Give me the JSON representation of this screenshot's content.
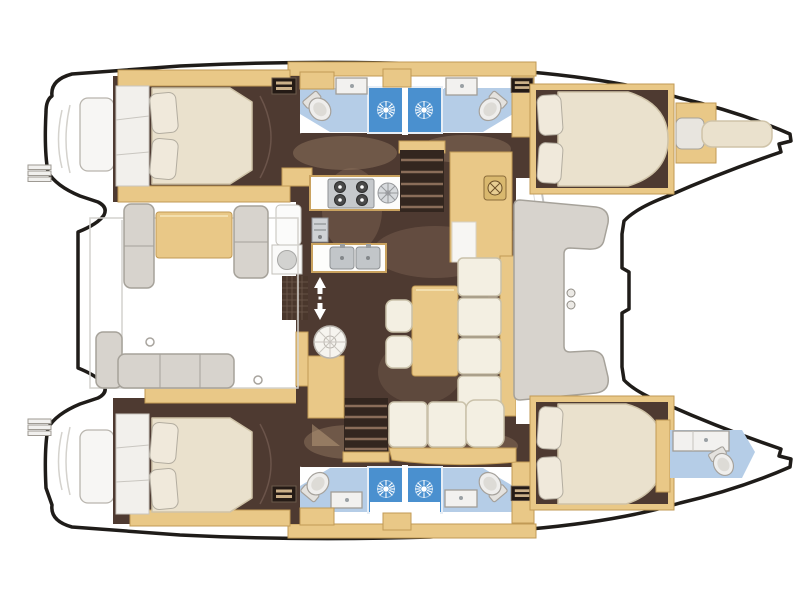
{
  "diagram": {
    "type": "boat-floor-plan",
    "subject": "catamaran-accommodation-layout-top-view",
    "orientation": "bows-right-sterns-left",
    "regions": [
      "port-stern-platform-with-steps",
      "starboard-stern-platform-with-steps",
      "aft-cockpit-with-table-and-benches",
      "port-aft-cabin-double-bed",
      "starboard-aft-cabin-double-bed",
      "port-aft-head-with-shower",
      "port-forward-head-with-shower",
      "starboard-aft-head-with-shower",
      "starboard-forward-head-with-shower",
      "saloon-galley-with-stove-and-sinks",
      "saloon-dinette-with-table-and-sofa",
      "nav-station-desk",
      "companionway-stairs-port",
      "companionway-stairs-starboard",
      "forward-cockpit-c-bench",
      "port-forward-cabin-double-bed",
      "starboard-forward-cabin-double-bed",
      "port-bow-crew-berth",
      "starboard-bow-head"
    ]
  },
  "colors": {
    "outline": "#1f1c19",
    "deck": "#ffffff",
    "deck_line": "#d4d2cd",
    "floor_dark": "#4e3a31",
    "floor_shadow": "#9a7f67",
    "wood": "#e9c887",
    "wood_edge": "#c19a55",
    "mattress": "#eae1cd",
    "mattress_edge": "#cfc3a8",
    "pillow": "#f0e9db",
    "bath_floor": "#b5cde7",
    "shower_blue": "#4a90cf",
    "shower_edge": "#e7eef6",
    "fixture_white": "#f2f1ef",
    "fixture_gray": "#d8d7d3",
    "fixture_edge": "#a29e97",
    "sofa": "#f3efe2",
    "sofa_edge": "#c9c1a9",
    "bench_gray": "#d7d3cd",
    "bench_edge": "#a6a29a",
    "steel": "#c3c7ca",
    "steel_dark": "#86898c",
    "stairs_dark": "#38281f",
    "stairs_light": "#8a6d59",
    "grate": "#4a372c"
  }
}
